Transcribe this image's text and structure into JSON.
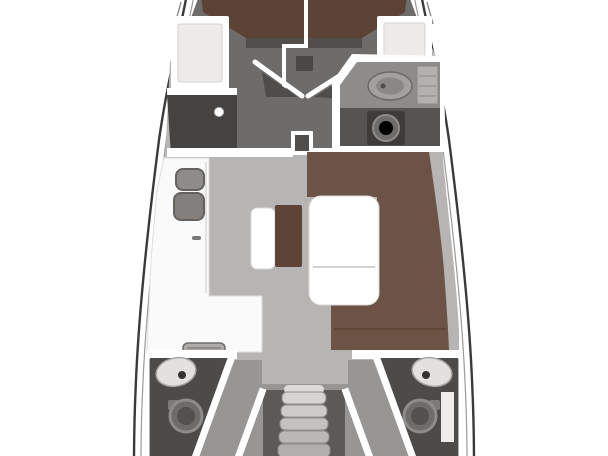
{
  "meta": {
    "title": "Sailing yacht interior floor plan (top-down deck layout)",
    "view": "plan-view"
  },
  "colors": {
    "page_background": "#ffffff",
    "hull_fill": "#ffffff",
    "hull_outline": "#3a3a3a",
    "fwd_cabin_floor": "#6e6c6a",
    "v_berth_wood": "#5c4336",
    "berth_foot_strip": "#524e4b",
    "salon_floor": "#b7b5b3",
    "aft_floor": "#989694",
    "stair_well": "#5c5a58",
    "stair_tread_top": "#d6d4d2",
    "stair_tread_mid": "#c4c2c0",
    "stair_tread_low": "#b2b0ae",
    "settee_upholstery": "#6d5346",
    "settee_backrest": "#5e4437",
    "wardrobe_dark": "#454341",
    "head_counter": "#8e8c8a",
    "head_floor_dark": "#565452",
    "aft_head_floor": "#4d4b49",
    "sink_metal": "#868482",
    "fixture_light": "#e3e1df",
    "toilet_gray": "#6e6c6a",
    "wall_white": "#ffffff"
  },
  "regions": [
    {
      "id": "forward-cabin",
      "kind": "cabin-with-v-berth"
    },
    {
      "id": "forward-head",
      "kind": "bathroom-sink-toilet"
    },
    {
      "id": "wardrobe",
      "kind": "closet"
    },
    {
      "id": "saloon",
      "kind": "u-settee-with-table"
    },
    {
      "id": "galley",
      "kind": "l-shaped-counter-sinks-stove"
    },
    {
      "id": "aft-port-head",
      "kind": "bathroom-sink-toilet"
    },
    {
      "id": "aft-starboard-head",
      "kind": "bathroom-sink-toilet"
    },
    {
      "id": "companionway",
      "kind": "entry-stairs"
    }
  ]
}
